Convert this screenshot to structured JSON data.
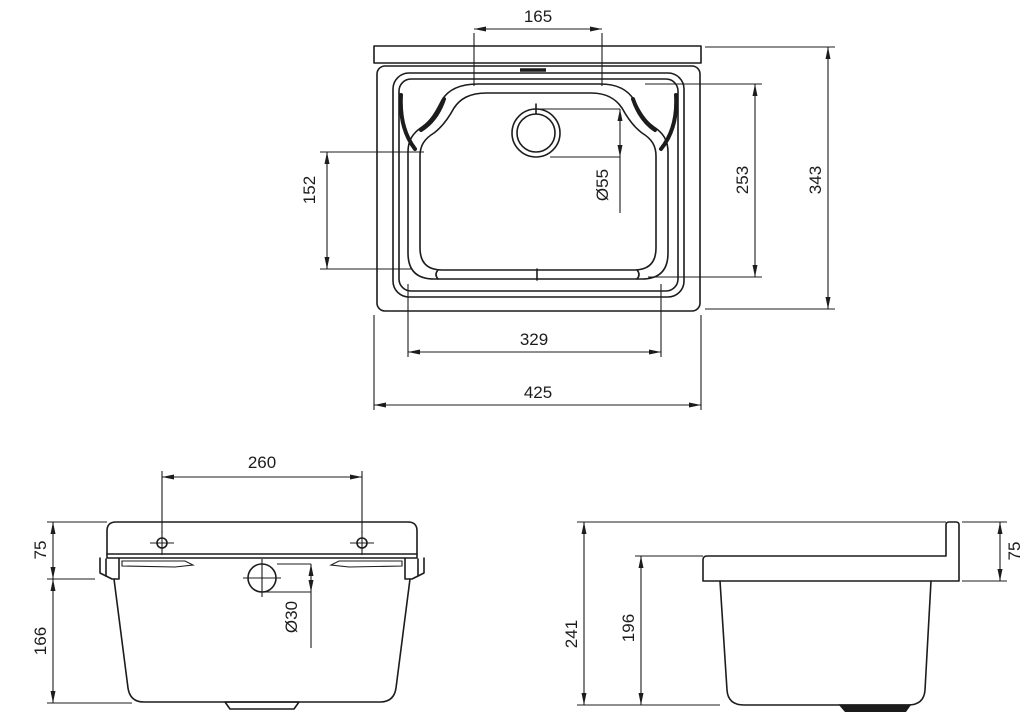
{
  "title": "Utility sink technical drawing",
  "colors": {
    "background": "#ffffff",
    "line": "#1c1c1c"
  },
  "views": {
    "top": {
      "name": "Top view",
      "dims": {
        "back_shelf_width": "165",
        "basin_depth_left": "152",
        "drain_diameter": "Ø55",
        "basin_depth_right": "253",
        "overall_depth": "343",
        "basin_width": "329",
        "overall_width": "425"
      }
    },
    "front": {
      "name": "Front view",
      "dims": {
        "mounting_hole_spacing": "260",
        "rim_height": "75",
        "body_height": "166",
        "overflow_diameter": "Ø30"
      }
    },
    "side": {
      "name": "Side view",
      "dims": {
        "overall_height": "241",
        "basin_inner_height": "196",
        "rim_height": "75"
      }
    }
  }
}
